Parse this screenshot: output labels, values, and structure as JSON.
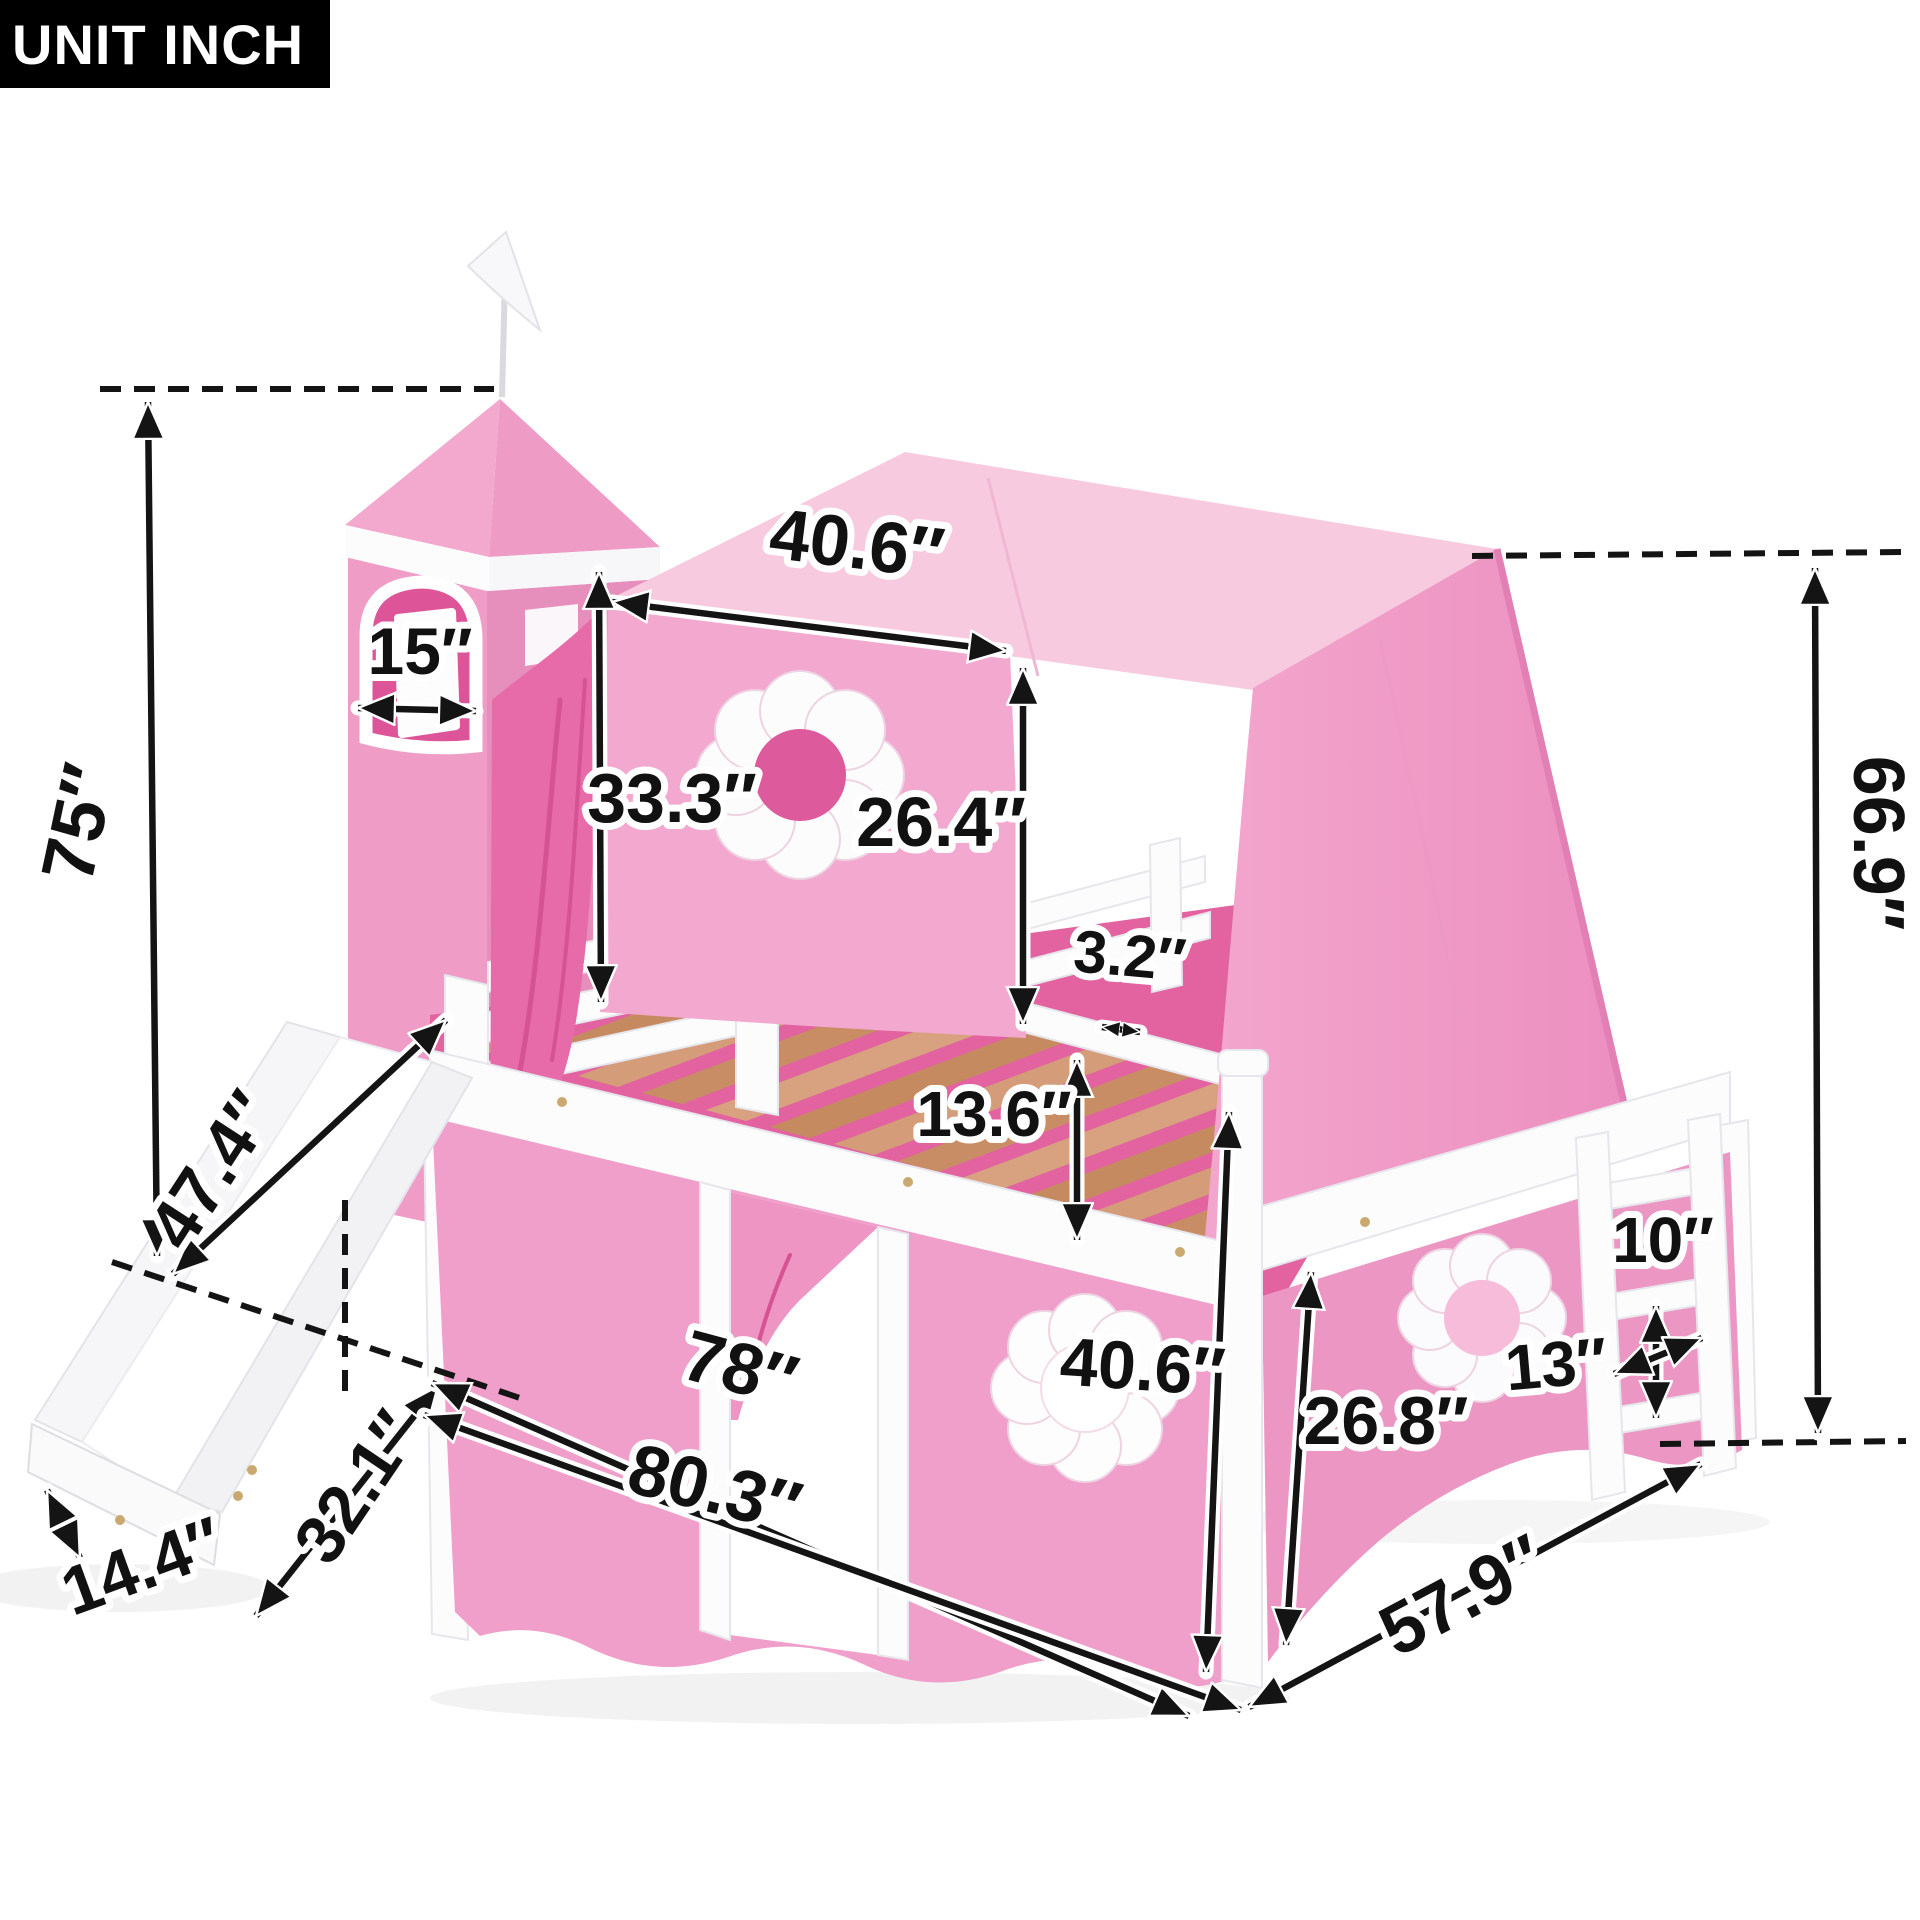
{
  "unit_badge": {
    "label": "UNIT INCH"
  },
  "product": {
    "subject": "castle loft bed with slide, tower, tent and ladder"
  },
  "palette": {
    "tent_pink": "#f3a8cf",
    "tent_top_pink": "#f8cadf",
    "tower_pink": "#ef9cc7",
    "hot_pink_drape": "#e76aa9",
    "curtain_pink": "#f09fca",
    "window_pink": "#dd5a9c",
    "frame_white": "#fcfcfd",
    "wood_slat": "#d49c79",
    "annotation_ink": "#141414"
  },
  "dimensions": {
    "tower_height": "75″",
    "tower_window_width": "15″",
    "tent_top_width": "40.6″",
    "tent_left_height": "33.3″",
    "tent_front_height": "26.4″",
    "slat_gap": "3.2″",
    "rail_height": "13.6″",
    "overall_height": "66.9″",
    "slide_length": "47.4″",
    "slide_run": "32.1″",
    "slide_width": "14.4″",
    "bed_length": "78″",
    "total_length": "80.3″",
    "under_bed_height": "40.6″",
    "curtain_height": "26.8″",
    "rung_spacing": "10″",
    "ladder_depth": "13″",
    "bed_depth": "57.9″"
  }
}
